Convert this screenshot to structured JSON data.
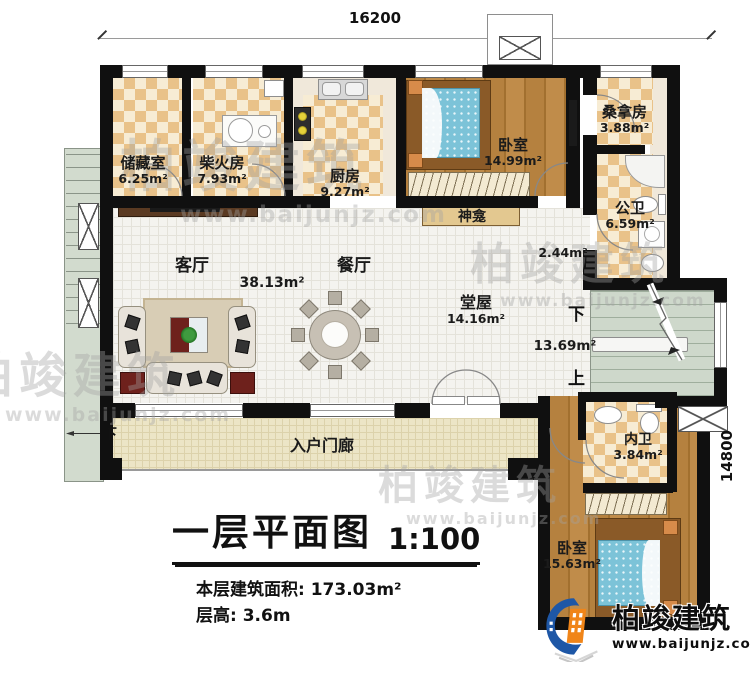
{
  "dimensions": {
    "top_width": "16200",
    "right_height": "14800"
  },
  "rooms": {
    "storage": {
      "name": "储藏室",
      "area": "6.25m²"
    },
    "firewood": {
      "name": "柴火房",
      "area": "7.93m²"
    },
    "kitchen": {
      "name": "厨房",
      "area": "9.27m²"
    },
    "bedroom_top": {
      "name": "卧室",
      "area": "14.99m²"
    },
    "sauna": {
      "name": "桑拿房",
      "area": "3.88m²"
    },
    "public_bath": {
      "name": "公卫",
      "area": "6.59m²"
    },
    "shrine": {
      "name": "神龛"
    },
    "hallway": {
      "area": "2.44m²"
    },
    "living": {
      "name": "客厅",
      "area": "38.13m²"
    },
    "dining": {
      "name": "餐厅"
    },
    "hall": {
      "name": "堂屋",
      "area": "14.16m²"
    },
    "stairwell": {
      "area": "13.69m²",
      "down": "下",
      "up": "上"
    },
    "inner_bath": {
      "name": "内卫",
      "area": "3.84m²"
    },
    "bedroom_bottom": {
      "name": "卧室",
      "area": "15.63m²"
    },
    "porch": {
      "name": "入户门廊",
      "down": "下"
    }
  },
  "title_block": {
    "title": "一层平面图",
    "scale": "1:100",
    "floor_area": "本层建筑面积: 173.03m²",
    "floor_height": "层高: 3.6m"
  },
  "branding": {
    "watermark_name": "柏竣建筑",
    "watermark_url": "www.baijunjz.com",
    "logo_name": "柏竣建筑",
    "logo_url": "www.baijunjz.com"
  }
}
